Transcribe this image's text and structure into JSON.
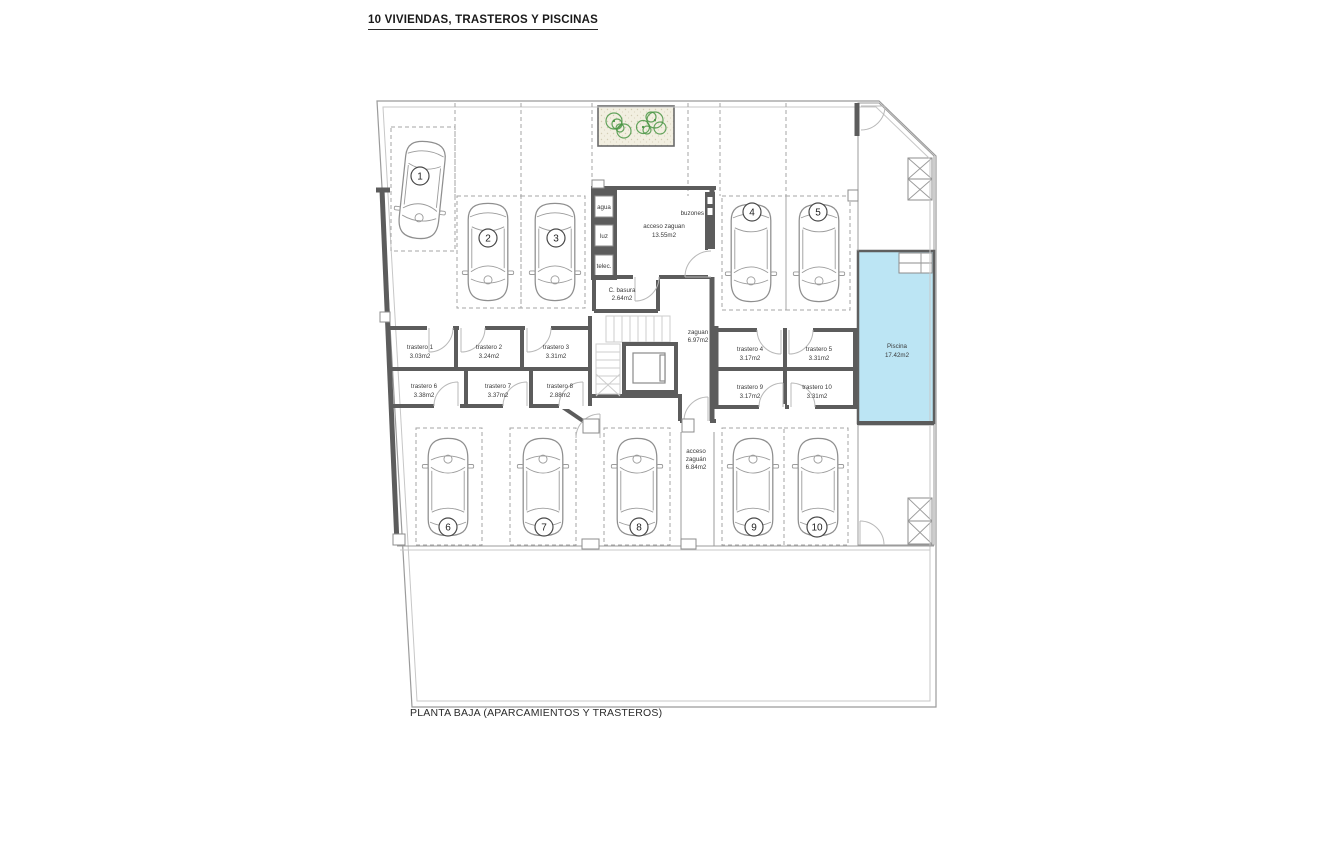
{
  "title": "10 VIVIENDAS, TRASTEROS Y PISCINAS",
  "caption": "PLANTA BAJA (APARCAMIENTOS Y TRASTEROS)",
  "utilities": {
    "agua": "agua",
    "luz": "luz",
    "telec": "telec.",
    "buzones": "buzones"
  },
  "rooms": {
    "acceso_zaguan": {
      "name": "acceso zaguan",
      "area": "13.55m2"
    },
    "c_basura": {
      "name": "C. basura",
      "area": "2.64m2"
    },
    "zaguan": {
      "name": "zaguan",
      "area": "6.97m2"
    },
    "acceso_sur": {
      "l1": "acceso",
      "l2": "zaguán",
      "l3": "6.84m2"
    },
    "piscina": {
      "name": "Piscina",
      "area": "17.42m2"
    }
  },
  "trasteros": [
    {
      "name": "trastero 1",
      "area": "3.03m2"
    },
    {
      "name": "trastero 2",
      "area": "3.24m2"
    },
    {
      "name": "trastero 3",
      "area": "3.31m2"
    },
    {
      "name": "trastero 4",
      "area": "3.17m2"
    },
    {
      "name": "trastero 5",
      "area": "3.31m2"
    },
    {
      "name": "trastero 6",
      "area": "3.38m2"
    },
    {
      "name": "trastero 7",
      "area": "3.37m2"
    },
    {
      "name": "trastero 8",
      "area": "2.88m2"
    },
    {
      "name": "trastero 9",
      "area": "3.17m2"
    },
    {
      "name": "trastero 10",
      "area": "3.31m2"
    }
  ],
  "parking": [
    "1",
    "2",
    "3",
    "4",
    "5",
    "6",
    "7",
    "8",
    "9",
    "10"
  ],
  "colors": {
    "wall": "#5c5c5c",
    "pool_water": "#bce5f4",
    "garden_green": "#e4eed6",
    "terrace_beige": "#f2efe1",
    "plant_green": "#4a9544",
    "line_gray": "#9b9b9b"
  }
}
